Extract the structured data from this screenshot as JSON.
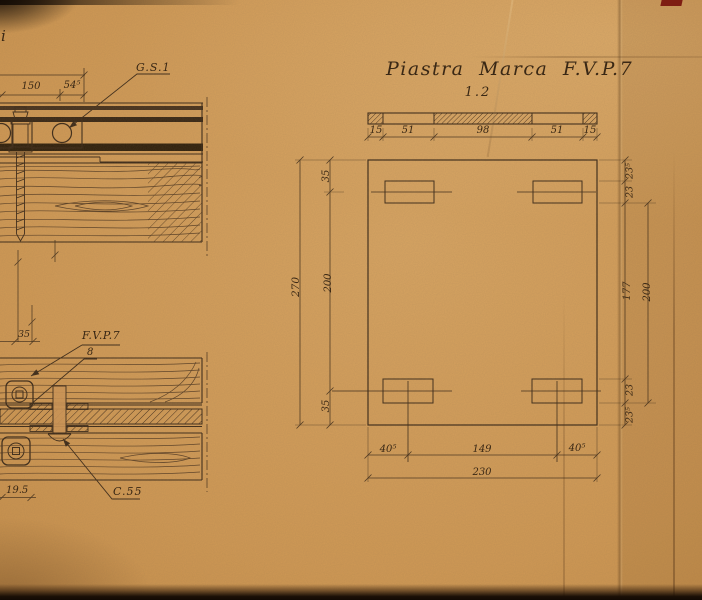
{
  "palette": {
    "paper": "#cc9754",
    "ink": "#3f2d1b",
    "dark_edge": "#160c04",
    "red_mark": "#7e1d12"
  },
  "left_drawings": {
    "corner_text": "i",
    "top_detail": {
      "label_gs1": "G.S.1",
      "dim_150": "150",
      "dim_54_5": "54⁵"
    },
    "bottom_detail": {
      "label_fvp7": "F.V.P.7",
      "dim_8": "8",
      "dim_35": "35",
      "label_c55": "C.55",
      "dim_19_5": "19.5"
    }
  },
  "plate_drawing": {
    "title": "Piastra Marca F.V.P.7",
    "scale_note": "1.2",
    "top_dims": [
      "15",
      "51",
      "98",
      "51",
      "15"
    ],
    "left_dims": {
      "overall": "270",
      "top": "35",
      "middle": "200",
      "bottom": "35"
    },
    "right_dims": {
      "seg1": "23⁵",
      "seg2": "23",
      "seg3": "177",
      "seg4": "23",
      "seg5": "23⁵",
      "outer": "200"
    },
    "bottom_dims": {
      "seg1": "40⁵",
      "seg2": "149",
      "seg3": "40⁵",
      "overall": "230"
    }
  }
}
